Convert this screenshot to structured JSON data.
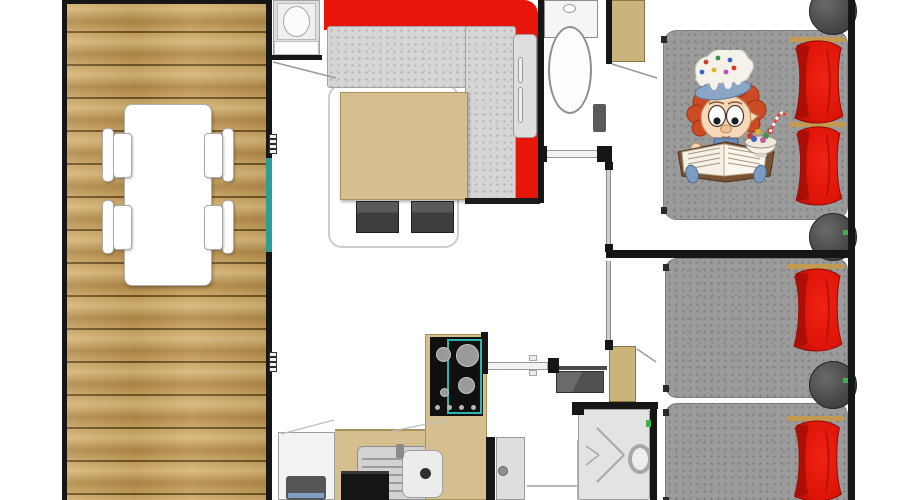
{
  "meta": {
    "title": "Mobile home floor plan",
    "view": "top-down 2D architectural plan, no visible text labels"
  },
  "colors": {
    "wall": "#161616",
    "floor": "#ffffff",
    "wood-base": "#c9a25e",
    "wood-light": "#d8b678",
    "wood-dark": "#b28a47",
    "wood-seam": "#6e5426",
    "sofa-red": "#e8150b",
    "pillow-red": "#dd1408",
    "pillow-red-dark": "#a50e04",
    "pillow-gold": "#c29a52",
    "tan": "#d5bf8e",
    "tan-dark": "#a5925c",
    "wardrobe-tan": "#c9b47c",
    "cushion-gray": "#d6d6d6",
    "bed-gray": "#9b9b9b",
    "teal": "#2f9c96",
    "hob-teal": "#2fb5ad",
    "appliance-black": "#151515",
    "green-accent": "#3db24a"
  },
  "rooms": [
    {
      "id": "terrace",
      "label": "Wooden terrace with dining table and four chairs"
    },
    {
      "id": "living-room",
      "label": "Living room with L-shaped red sofa, coffee table, two stools and rug"
    },
    {
      "id": "kitchen",
      "label": "Kitchen with fridge, oven, sink, worktops and 4-burner gas hob"
    },
    {
      "id": "wc",
      "label": "Separate WC with toilet and paper holder"
    },
    {
      "id": "hallway",
      "label": "Hallway with wall heater, wardrobe and cabinet"
    },
    {
      "id": "shower-room",
      "label": "Shower room with shower tray and drain"
    },
    {
      "id": "bedroom-double",
      "label": "Master bedroom with double bed, two red pillows and round side tables"
    },
    {
      "id": "bedroom-twin",
      "label": "Twin bedroom with two single beds, red pillows and round side table"
    }
  ],
  "furniture": [
    "dining-table",
    "chair",
    "chair",
    "chair",
    "chair",
    "l-shaped-sofa",
    "coffee-table",
    "stool",
    "stool",
    "rug",
    "kitchen-top-unit-with-basin",
    "fridge",
    "oven",
    "sink-with-drainer",
    "gas-hob",
    "toilet",
    "toilet-paper-holder",
    "wardrobe",
    "cabinet",
    "wall-heater",
    "shower-tray",
    "entrance-door",
    "sliding-door",
    "sliding-door",
    "double-bed",
    "single-bed",
    "single-bed",
    "round-side-table",
    "round-side-table",
    "round-side-table"
  ],
  "illustration": {
    "name": "mascot-child-reading",
    "description": "Cartoon child with red curly hair wearing a frosted cupcake hat, reading an open book beside a bowl of sweets, printed on the double bed"
  }
}
